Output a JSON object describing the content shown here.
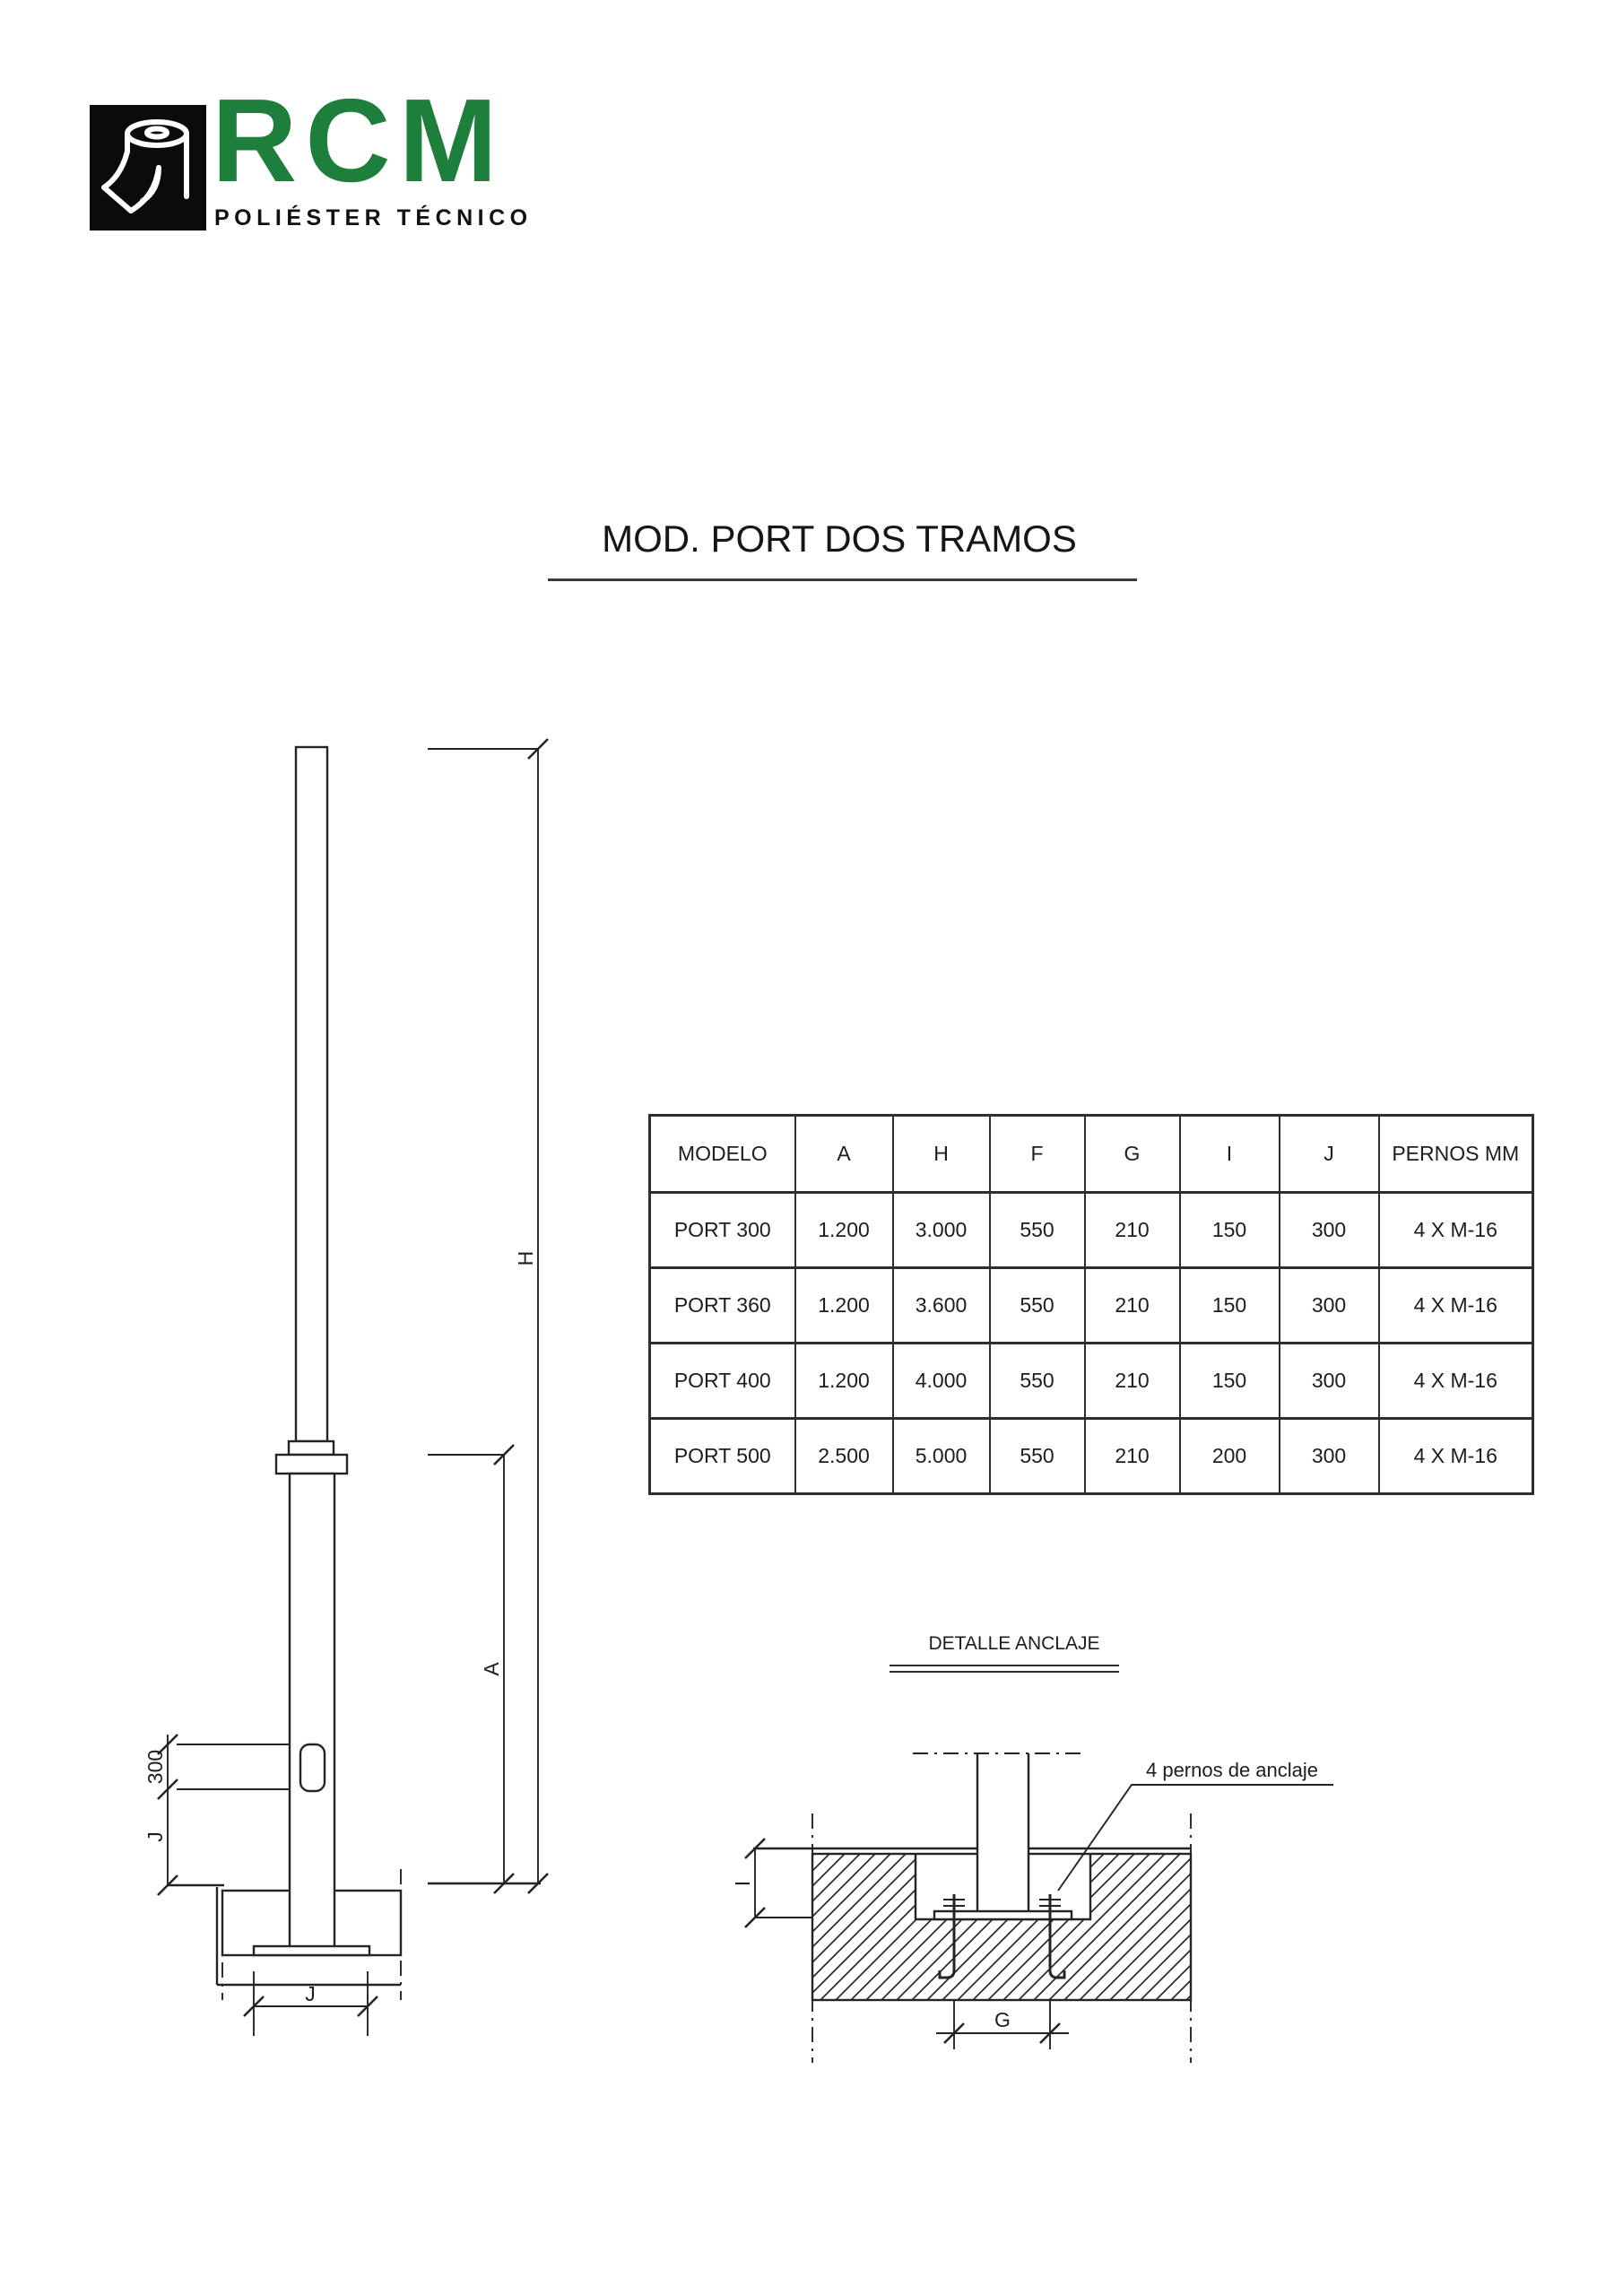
{
  "page": {
    "background": "#ffffff",
    "ink": "#1d1d1d"
  },
  "logo": {
    "brand": "RCM",
    "tagline": "POLIÉSTER TÉCNICO",
    "brand_color": "#1E7E3C",
    "mark_icon": "polyester-roll-icon"
  },
  "title": {
    "text": "MOD. PORT DOS TRAMOS"
  },
  "spec_table": {
    "headers": [
      "MODELO",
      "A",
      "H",
      "F",
      "G",
      "I",
      "J",
      "PERNOS MM"
    ],
    "rows": [
      [
        "PORT 300",
        "1.200",
        "3.000",
        "550",
        "210",
        "150",
        "300",
        "4 X M-16"
      ],
      [
        "PORT 360",
        "1.200",
        "3.600",
        "550",
        "210",
        "150",
        "300",
        "4 X M-16"
      ],
      [
        "PORT 400",
        "1.200",
        "4.000",
        "550",
        "210",
        "150",
        "300",
        "4 X M-16"
      ],
      [
        "PORT 500",
        "2.500",
        "5.000",
        "550",
        "210",
        "200",
        "300",
        "4 X M-16"
      ]
    ]
  },
  "pole_drawing": {
    "dims": {
      "h": "H",
      "a": "A",
      "door": "300",
      "j_side": "J",
      "j_base": "J"
    }
  },
  "anchor_detail": {
    "title": "DETALLE ANCLAJE",
    "callout": "4 pernos de anclaje",
    "dims": {
      "i": "I",
      "g": "G"
    }
  }
}
